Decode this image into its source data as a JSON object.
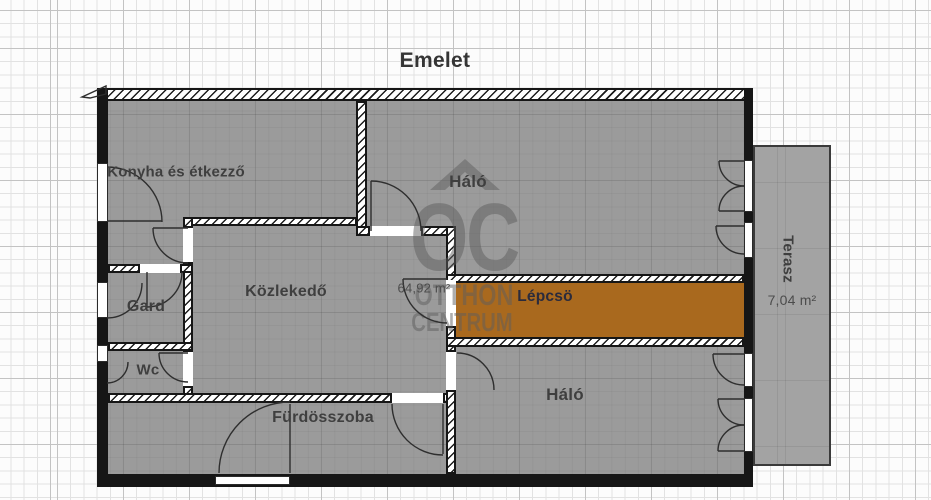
{
  "title": "Emelet",
  "rooms": {
    "kitchen_dining": {
      "label": "Konyha és étkezző"
    },
    "bedroom_top": {
      "label": "Háló"
    },
    "hallway": {
      "label": "Közlekedő"
    },
    "wardrobe": {
      "label": "Gard"
    },
    "wc": {
      "label": "Wc"
    },
    "bathroom": {
      "label": "Fürdösszoba"
    },
    "stairs": {
      "label": "Lépcsö"
    },
    "bedroom_bottom": {
      "label": "Háló"
    },
    "terrace": {
      "label": "Terasz",
      "area": "7,04 m²"
    }
  },
  "floor_area_label": "64,92 m²",
  "watermark": {
    "initials": "OC",
    "line1": "OTTHON",
    "line2": "CENTRUM"
  },
  "colors": {
    "stairs_fill": "#a9691e",
    "room_fill": "#9b9b9b",
    "terrace_fill": "#a3a3a3",
    "wall": "#161616",
    "label": "#3f3f3f",
    "stairs_label": "#2b2b3c"
  }
}
